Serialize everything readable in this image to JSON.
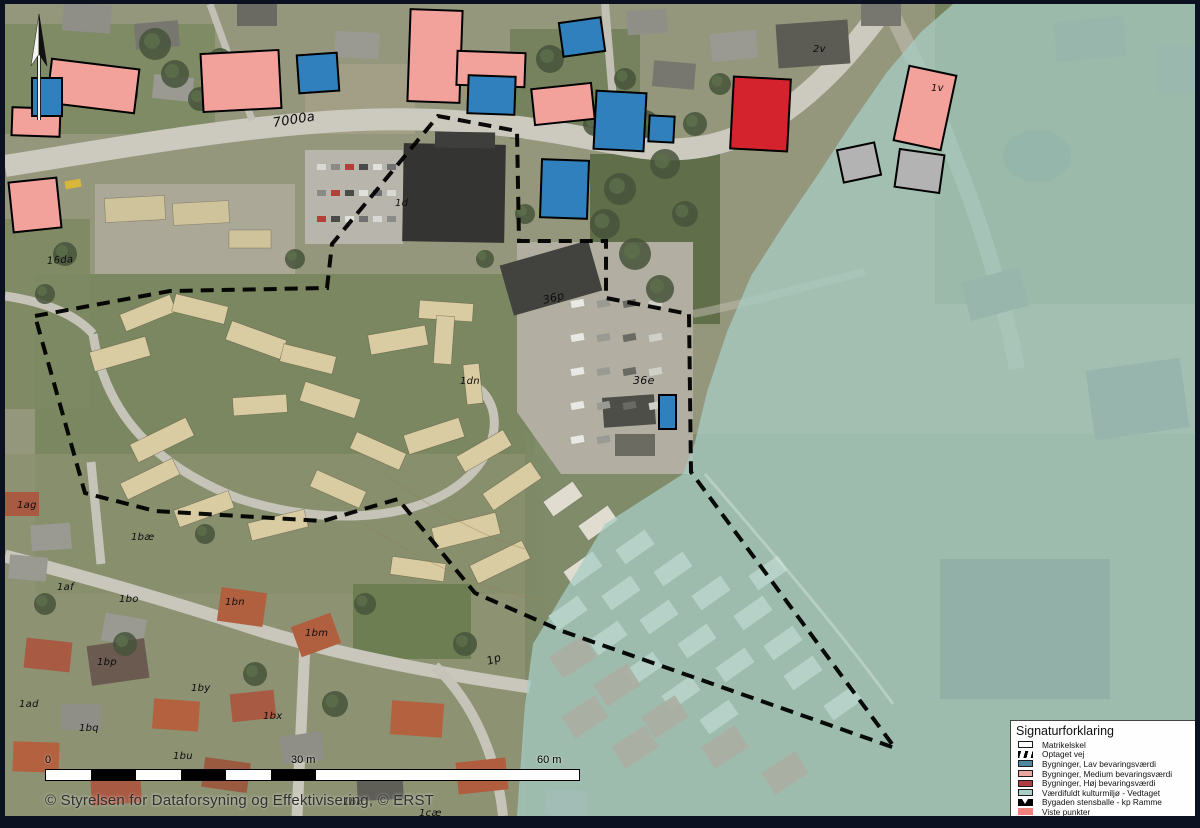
{
  "map": {
    "scale_bar": {
      "tick0": "0",
      "tick1": "30 m",
      "tick2": "60 m"
    },
    "copyright": "© Styrelsen for Dataforsyning og Effektivisering, © ERST",
    "labels": [
      {
        "text": "7000a",
        "x": 268,
        "y": 112,
        "rot": -9,
        "size": 13
      },
      {
        "text": "16da",
        "x": 42,
        "y": 252,
        "rot": -4,
        "size": 10
      },
      {
        "text": "1d",
        "x": 390,
        "y": 194,
        "rot": 0,
        "size": 10
      },
      {
        "text": "36p",
        "x": 538,
        "y": 290,
        "rot": -14,
        "size": 11
      },
      {
        "text": "36e",
        "x": 628,
        "y": 370,
        "rot": 0,
        "size": 11
      },
      {
        "text": "1dn",
        "x": 455,
        "y": 372,
        "rot": 0,
        "size": 10
      },
      {
        "text": "1ag",
        "x": 12,
        "y": 496,
        "rot": 0,
        "size": 10
      },
      {
        "text": "1bæ",
        "x": 126,
        "y": 528,
        "rot": 0,
        "size": 10
      },
      {
        "text": "1af",
        "x": 52,
        "y": 578,
        "rot": 0,
        "size": 10
      },
      {
        "text": "1bo",
        "x": 114,
        "y": 590,
        "rot": 0,
        "size": 10
      },
      {
        "text": "1bn",
        "x": 220,
        "y": 593,
        "rot": 0,
        "size": 10
      },
      {
        "text": "1bm",
        "x": 300,
        "y": 624,
        "rot": 0,
        "size": 10
      },
      {
        "text": "1bp",
        "x": 92,
        "y": 653,
        "rot": 0,
        "size": 10
      },
      {
        "text": "1by",
        "x": 186,
        "y": 679,
        "rot": 0,
        "size": 10
      },
      {
        "text": "1ad",
        "x": 14,
        "y": 695,
        "rot": 0,
        "size": 10
      },
      {
        "text": "1bq",
        "x": 74,
        "y": 719,
        "rot": 0,
        "size": 10
      },
      {
        "text": "1bx",
        "x": 258,
        "y": 707,
        "rot": 0,
        "size": 10
      },
      {
        "text": "1bu",
        "x": 168,
        "y": 747,
        "rot": 0,
        "size": 10
      },
      {
        "text": "1bv",
        "x": 242,
        "y": 765,
        "rot": 0,
        "size": 10
      },
      {
        "text": "1bk",
        "x": 338,
        "y": 793,
        "rot": 0,
        "size": 10
      },
      {
        "text": "1cæ",
        "x": 414,
        "y": 804,
        "rot": 0,
        "size": 10
      },
      {
        "text": "1p",
        "x": 482,
        "y": 651,
        "rot": -18,
        "size": 11
      },
      {
        "text": "2v",
        "x": 808,
        "y": 40,
        "rot": 0,
        "size": 10
      },
      {
        "text": "1v",
        "x": 926,
        "y": 79,
        "rot": 0,
        "size": 10
      }
    ]
  },
  "legend": {
    "title": "Signaturforklaring",
    "items": [
      {
        "label": "Matrikelskel",
        "type": "outline",
        "color": "#ffffff"
      },
      {
        "label": "Optaget vej",
        "type": "hatch",
        "color": "#000000"
      },
      {
        "label": "Bygninger, Lav bevaringsværdi",
        "type": "fill",
        "color": "#4e87a0"
      },
      {
        "label": "Bygninger, Medium bevaringsværdi",
        "type": "fill",
        "color": "#eda59f"
      },
      {
        "label": "Bygninger, Høj bevaringsværdi",
        "type": "fill",
        "color": "#b13b42"
      },
      {
        "label": "Værdifuldt kulturmiljø - Vedtaget",
        "type": "fill",
        "color": "#aacfc7"
      },
      {
        "label": "Bygaden stensballe - kp Ramme",
        "type": "kp",
        "color": "#000000"
      },
      {
        "label": "Viste punkter",
        "type": "noborder",
        "color": "#f0827d"
      }
    ]
  },
  "overlays": {
    "culture_area_color": "#a7cdc5",
    "culture_area_opacity": 0.74,
    "culture_polygon": [
      [
        948,
        0
      ],
      [
        1190,
        0
      ],
      [
        1190,
        812
      ],
      [
        512,
        812
      ],
      [
        520,
        700
      ],
      [
        528,
        640
      ],
      [
        600,
        520
      ],
      [
        678,
        470
      ],
      [
        690,
        438
      ],
      [
        702,
        388
      ],
      [
        722,
        328
      ],
      [
        746,
        272
      ],
      [
        778,
        222
      ],
      [
        812,
        172
      ],
      [
        846,
        120
      ],
      [
        882,
        68
      ],
      [
        916,
        28
      ]
    ],
    "boundary_color": "#000000",
    "boundary": [
      [
        30,
        312
      ],
      [
        165,
        287
      ],
      [
        322,
        284
      ],
      [
        327,
        240
      ],
      [
        433,
        112
      ],
      [
        512,
        127
      ],
      [
        514,
        237
      ],
      [
        601,
        237
      ],
      [
        601,
        294
      ],
      [
        684,
        310
      ],
      [
        686,
        468
      ],
      [
        890,
        744
      ],
      [
        557,
        627
      ],
      [
        470,
        589
      ],
      [
        393,
        495
      ],
      [
        318,
        517
      ],
      [
        150,
        507
      ],
      [
        80,
        489
      ],
      [
        30,
        312
      ]
    ],
    "building_colors": {
      "blue": "#2f80bd",
      "salmon": "#f2a29b",
      "red": "#d5232e",
      "gray": "#b3b3b3"
    },
    "buildings": {
      "blue": [
        [
          27,
          74,
          30,
          38,
          0
        ],
        [
          293,
          50,
          40,
          38,
          -4
        ],
        [
          463,
          72,
          47,
          38,
          2
        ],
        [
          556,
          16,
          42,
          34,
          -8
        ],
        [
          590,
          88,
          50,
          58,
          3
        ],
        [
          644,
          112,
          25,
          26,
          3
        ],
        [
          536,
          156,
          47,
          58,
          2
        ],
        [
          654,
          391,
          17,
          34,
          0
        ]
      ],
      "salmon": [
        [
          44,
          60,
          88,
          44,
          7
        ],
        [
          7,
          104,
          48,
          28,
          2
        ],
        [
          6,
          176,
          48,
          50,
          -6
        ],
        [
          197,
          48,
          78,
          58,
          -3
        ],
        [
          404,
          6,
          52,
          92,
          2
        ],
        [
          452,
          48,
          68,
          34,
          2
        ],
        [
          528,
          82,
          60,
          36,
          -6
        ],
        [
          896,
          66,
          48,
          76,
          12
        ]
      ],
      "red": [
        [
          727,
          74,
          57,
          72,
          3
        ]
      ],
      "gray": [
        [
          835,
          142,
          38,
          33,
          -12
        ],
        [
          892,
          148,
          45,
          38,
          8
        ]
      ]
    }
  }
}
